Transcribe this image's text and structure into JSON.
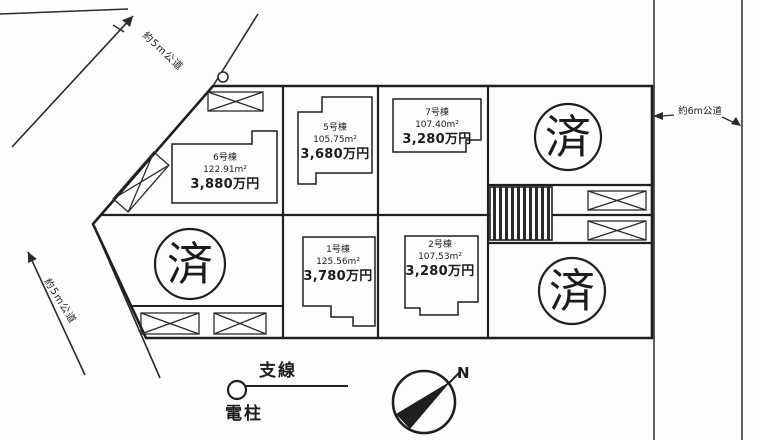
{
  "map": {
    "type": "real-estate-lot-layout",
    "colors": {
      "ink": "#1c1c1c",
      "paper": "#fdfdfd"
    },
    "roads": {
      "northwest_label": "約5m公道",
      "southwest_label": "約5m公道",
      "east_label": "約6m公道"
    },
    "lots": [
      {
        "name": "6号棟",
        "area": "122.91m²",
        "price": "3,880万円"
      },
      {
        "name": "5号棟",
        "area": "105.75m²",
        "price": "3,680万円"
      },
      {
        "name": "7号棟",
        "area": "107.40m²",
        "price": "3,280万円"
      },
      {
        "name": "1号棟",
        "area": "125.56m²",
        "price": "3,780万円"
      },
      {
        "name": "2号棟",
        "area": "107.53m²",
        "price": "3,280万円"
      }
    ],
    "sold_label": "済",
    "legend": {
      "guy_wire": "支線",
      "utility_pole": "電柱",
      "north": "N"
    }
  }
}
